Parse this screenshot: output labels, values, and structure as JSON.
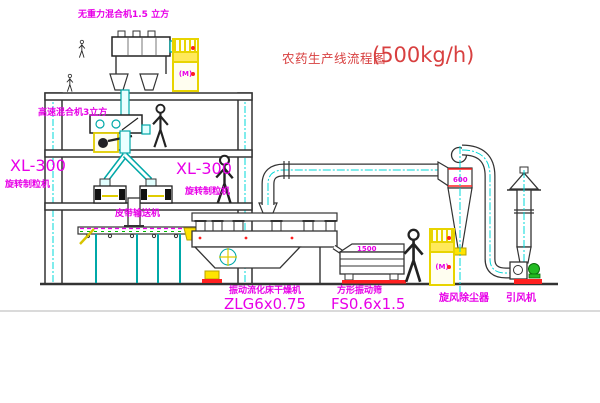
{
  "title": {
    "text": "农药生产线流程图",
    "capacity": "(500kg/h)"
  },
  "equipment_labels": {
    "weightless_mixer": "无重力混合机1.5 立方",
    "high_speed_mixer": "高速混合机3立方",
    "granulator_left": {
      "model": "XL-300",
      "name": "旋转制粒机"
    },
    "granulator_right": {
      "model": "XL-300",
      "name": "旋转制粒机"
    },
    "belt_conveyor": "皮带输送机",
    "fluid_bed_dryer": {
      "name": "振动流化床干燥机",
      "model": "ZLG6x0.75"
    },
    "square_sifter": {
      "name": "方形振动筛",
      "model": "FS0.6x1.5"
    },
    "cyclone": "旋风除尘器",
    "induced_draft_fan": "引风机"
  },
  "annotations": {
    "cyclone_dim": "600",
    "sifter_dim": "1500",
    "cabinet_mark": "(M)"
  },
  "colors": {
    "label_magenta": "#e800e8",
    "title_red": "#d84040",
    "centerline_cyan": "#00d8d8",
    "equipment_yellow": "#ffe400",
    "alert_red": "#ff2020",
    "motor_green": "#22bb22",
    "line_dark": "#333333"
  }
}
